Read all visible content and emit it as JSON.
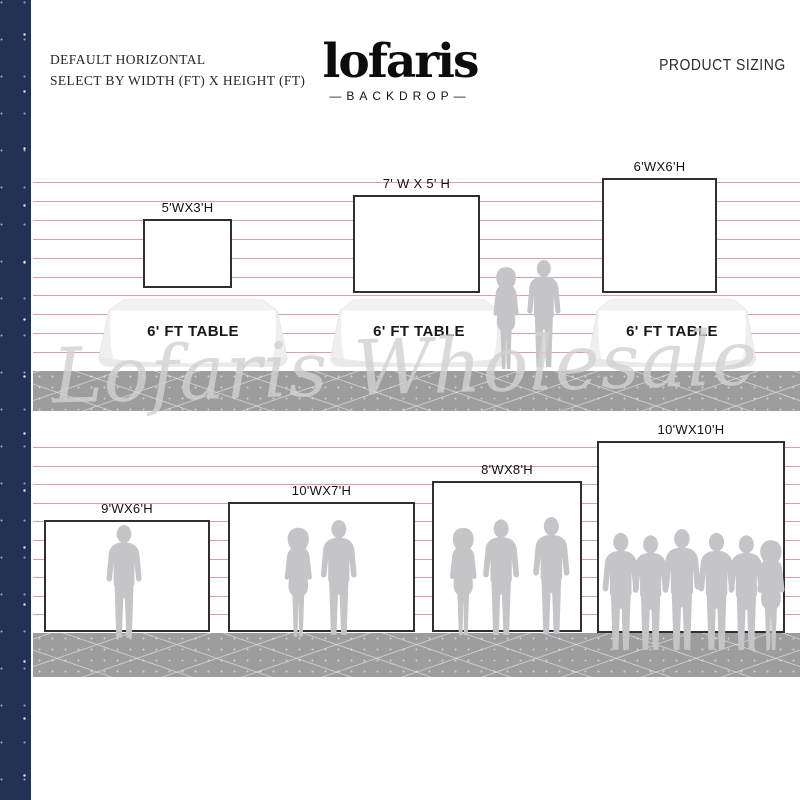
{
  "header": {
    "tagline_line1": "DEFAULT HORIZONTAL",
    "tagline_line2": "SELECT BY WIDTH (FT) X HEIGHT (FT)",
    "logo_text": "lofaris",
    "logo_subtext": "—BACKDROP—",
    "product_sizing_label": "PRODUCT SIZING"
  },
  "watermark_text": "Lofaris Wholesale",
  "ruler": {
    "labels": [
      "10'",
      "9'",
      "8'",
      "7'",
      "6'",
      "5'",
      "4'",
      "3'",
      "2'",
      "1'"
    ]
  },
  "rows": [
    {
      "name": "row-1",
      "backdrop_labels": [
        "5'WX3'H",
        "7' W X 5' H",
        "6'WX6'H"
      ],
      "table_label": "6' FT TABLE"
    },
    {
      "name": "row-2",
      "backdrop_labels": [
        "9'WX6'H",
        "10'WX7'H",
        "8'WX8'H",
        "10'WX10'H"
      ]
    }
  ],
  "colors": {
    "navy_strip": "#233155",
    "wall_line_pink": "#dc9fa9",
    "floor_gray": "#9d9d9d",
    "silhouette_gray": "#c5c5c8",
    "backdrop_border": "#2f2f2f",
    "watermark_gray": "#d2d2d2"
  }
}
